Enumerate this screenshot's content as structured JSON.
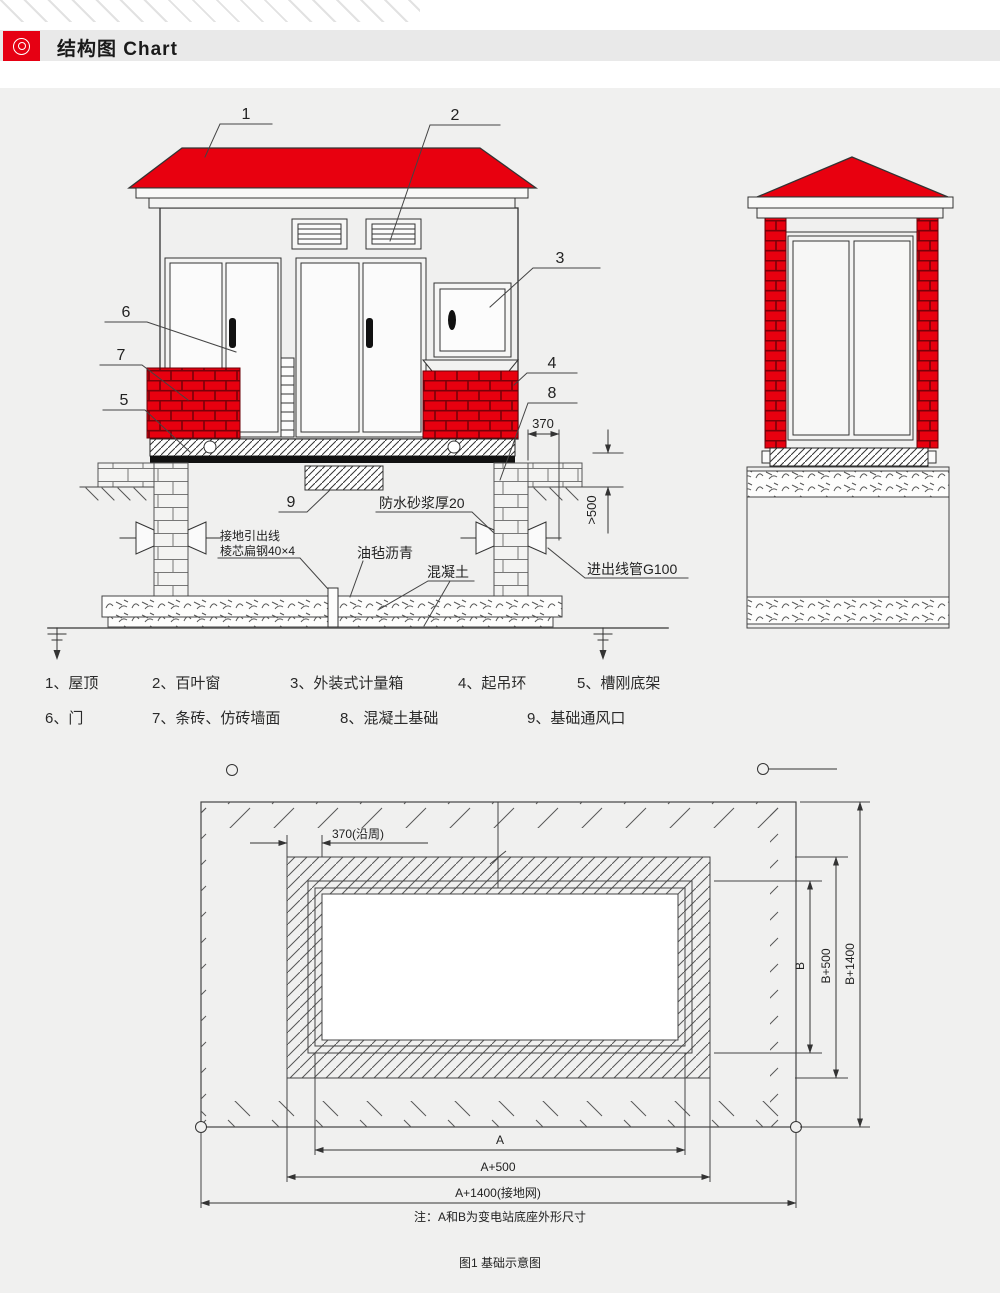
{
  "header": {
    "title": "结构图 Chart",
    "icon": "target-icon"
  },
  "colors": {
    "accent_red": "#e60012",
    "brick_red": "#e8000f",
    "mortar": "#7a0008",
    "line": "#333333",
    "panel_bg": "#f0f0ef",
    "header_bar": "#e9e9e9"
  },
  "front": {
    "callouts": [
      "1",
      "2",
      "3",
      "4",
      "5",
      "6",
      "7",
      "8",
      "9"
    ],
    "dim_370": "370",
    "dim_500": ">500",
    "label_waterproof": "防水砂浆厚20",
    "label_ground1": "接地引出线",
    "label_ground2": "棱芯扁钢40×4",
    "label_felt": "油毡沥青",
    "label_concrete": "混凝土",
    "label_pipe": "进出线管G100"
  },
  "legend": {
    "items": [
      "1、屋顶",
      "2、百叶窗",
      "3、外装式计量箱",
      "4、起吊环",
      "5、槽刚底架",
      "6、门",
      "7、条砖、仿砖墙面",
      "8、混凝土基础",
      "9、基础通风口"
    ]
  },
  "plan": {
    "dim_370": "370(沿周)",
    "dim_a": "A",
    "dim_a500": "A+500",
    "dim_a1400": "A+1400(接地网)",
    "dim_b": "B",
    "dim_b500": "B+500",
    "dim_b1400": "B+1400",
    "note": "注：A和B为变电站底座外形尺寸",
    "caption": "图1 基础示意图"
  }
}
